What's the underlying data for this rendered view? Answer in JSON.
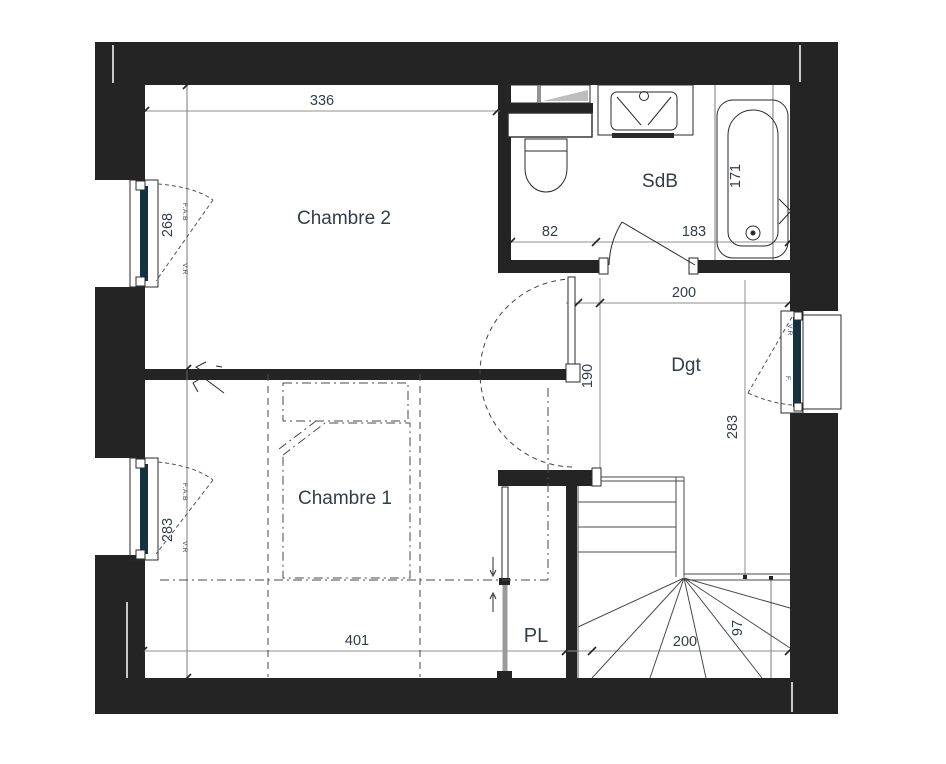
{
  "rooms": {
    "chambre2": "Chambre 2",
    "chambre1": "Chambre 1",
    "sdb": "SdB",
    "dgt": "Dgt",
    "pl": "PL"
  },
  "dimensions": {
    "d336": "336",
    "d82": "82",
    "d183": "183",
    "d171": "171",
    "d268": "268",
    "d283_left": "283",
    "d200_dgt": "200",
    "d190": "190",
    "d283_dgt": "283",
    "d401": "401",
    "d200_stairs": "200",
    "d97": "97"
  },
  "window_labels": {
    "w1_type": "F.A.B",
    "w1_shutter": "V.R",
    "w2_type": "F.A.B",
    "w2_shutter": "V.R",
    "w3_shutter": "V.R",
    "w3_type": "F."
  },
  "colors": {
    "wall": "#242424",
    "glass": "#16323e",
    "dim_text": "#333d47",
    "shade": "#bdbdbd",
    "panel_gray": "#9a9a9a"
  }
}
